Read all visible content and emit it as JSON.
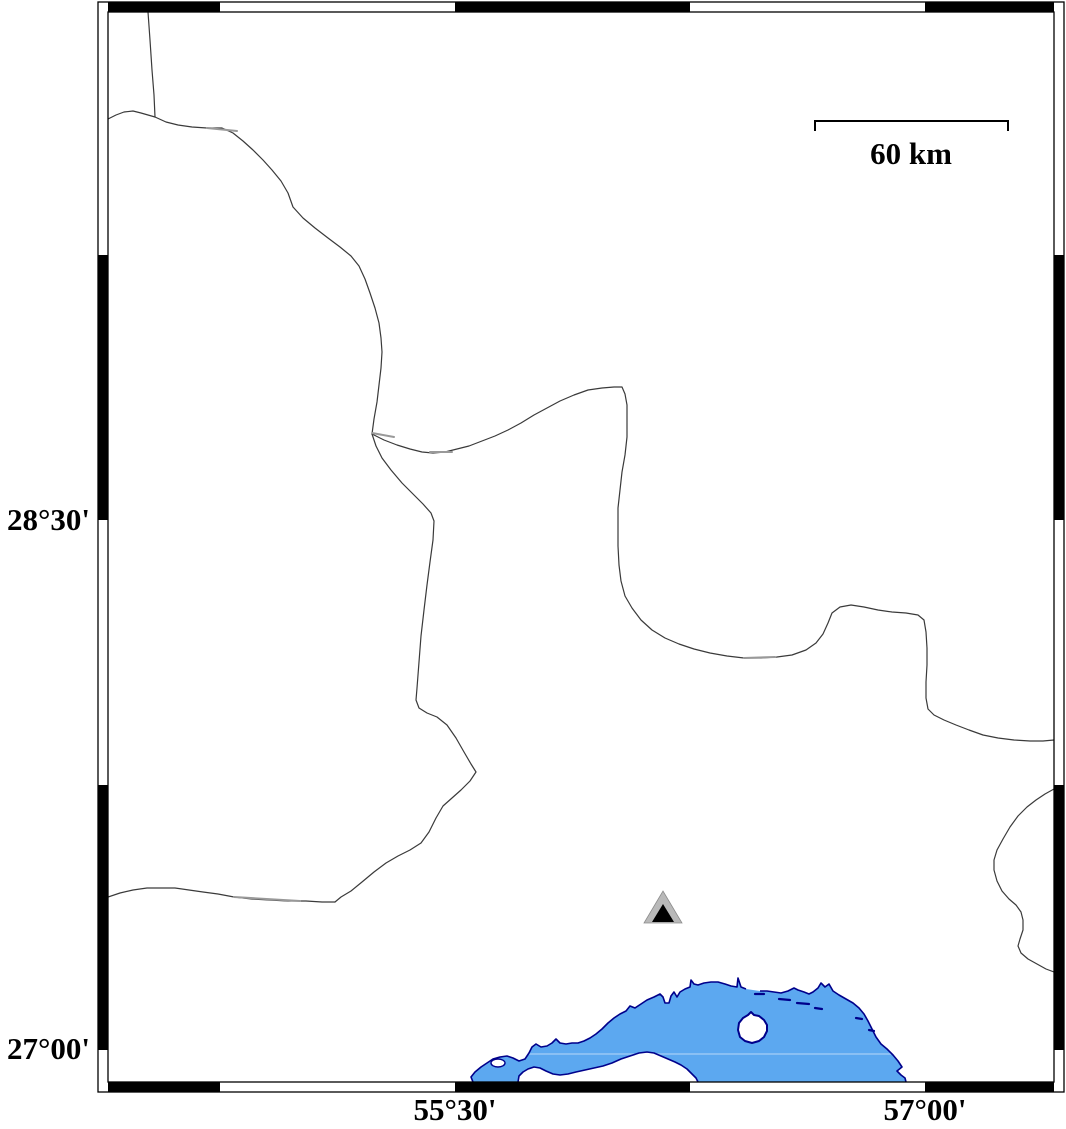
{
  "figure": {
    "width": 1066,
    "height": 1129,
    "background": "#ffffff"
  },
  "labels": {
    "lat_top": "28°30'",
    "lat_bottom": "27°00'",
    "lon_left": "55°30'",
    "lon_right": "57°00'"
  },
  "label_positions": {
    "lat_top": {
      "top": 503
    },
    "lat_bottom": {
      "top": 1032
    },
    "lon_left": {
      "left": 375,
      "top": 1093
    },
    "lon_right": {
      "left": 845,
      "top": 1093
    }
  },
  "scalebar": {
    "label": "60 km",
    "x1": 815,
    "x2": 1008,
    "y": 121,
    "cap_drop": 10,
    "label_left": 831,
    "label_top": 137
  },
  "colors": {
    "sea_fill": "#5ca8f0",
    "coast_stroke": "#00008b",
    "boundary": "#3a3a3a",
    "boundary_overlap": "#999999",
    "frame": "#000000",
    "marker_outer": "#b9b9b9",
    "marker_inner": "#000000",
    "seam": "rgba(255,255,255,0.45)"
  },
  "frame": {
    "outer": [
      98,
      2,
      1064,
      1092
    ],
    "inner": [
      108,
      12,
      1054,
      1082
    ],
    "top_black_segments": [
      [
        108,
        220
      ],
      [
        455,
        690
      ],
      [
        925,
        1054
      ]
    ],
    "bottom_black_segments": [
      [
        108,
        220
      ],
      [
        455,
        690
      ],
      [
        925,
        1054
      ]
    ],
    "left_black_segments": [
      [
        255,
        520
      ],
      [
        785,
        1050
      ]
    ],
    "right_black_segments": [
      [
        255,
        520
      ],
      [
        785,
        1050
      ]
    ]
  },
  "map_data": {
    "boundaries": [
      [
        [
          148,
          12
        ],
        [
          150,
          40
        ],
        [
          152,
          70
        ],
        [
          154,
          95
        ],
        [
          155,
          117
        ]
      ],
      [
        [
          108,
          119
        ],
        [
          116,
          115
        ],
        [
          124,
          112
        ],
        [
          133,
          111
        ],
        [
          141,
          113
        ],
        [
          148,
          115
        ],
        [
          155,
          117
        ]
      ],
      [
        [
          155,
          117
        ],
        [
          166,
          122
        ],
        [
          178,
          125
        ],
        [
          192,
          127
        ],
        [
          207,
          128
        ],
        [
          222,
          128
        ],
        [
          233,
          133
        ],
        [
          243,
          141
        ],
        [
          253,
          150
        ],
        [
          263,
          160
        ],
        [
          272,
          170
        ],
        [
          281,
          181
        ],
        [
          288,
          193
        ],
        [
          293,
          207
        ],
        [
          303,
          218
        ],
        [
          315,
          228
        ],
        [
          328,
          238
        ],
        [
          340,
          247
        ],
        [
          351,
          256
        ],
        [
          359,
          266
        ],
        [
          365,
          279
        ],
        [
          370,
          293
        ],
        [
          375,
          308
        ],
        [
          379,
          323
        ],
        [
          381,
          338
        ],
        [
          382,
          352
        ],
        [
          381,
          368
        ],
        [
          379,
          385
        ],
        [
          377,
          402
        ],
        [
          374,
          419
        ],
        [
          372,
          434
        ]
      ],
      [
        [
          372,
          434
        ],
        [
          376,
          446
        ],
        [
          382,
          458
        ],
        [
          391,
          470
        ],
        [
          402,
          483
        ],
        [
          413,
          494
        ],
        [
          423,
          504
        ],
        [
          431,
          513
        ],
        [
          434,
          521
        ],
        [
          433,
          540
        ],
        [
          430,
          562
        ],
        [
          427,
          585
        ],
        [
          424,
          610
        ],
        [
          421,
          636
        ],
        [
          419,
          662
        ],
        [
          417,
          688
        ],
        [
          416,
          700
        ],
        [
          419,
          708
        ],
        [
          427,
          713
        ],
        [
          437,
          717
        ],
        [
          447,
          725
        ],
        [
          456,
          738
        ],
        [
          464,
          752
        ],
        [
          471,
          764
        ],
        [
          476,
          772
        ],
        [
          470,
          781
        ],
        [
          461,
          790
        ],
        [
          452,
          798
        ],
        [
          443,
          806
        ],
        [
          436,
          818
        ],
        [
          429,
          832
        ],
        [
          421,
          843
        ],
        [
          410,
          850
        ],
        [
          398,
          856
        ],
        [
          386,
          863
        ],
        [
          374,
          872
        ],
        [
          362,
          882
        ],
        [
          351,
          891
        ],
        [
          341,
          897
        ],
        [
          335,
          902
        ]
      ],
      [
        [
          108,
          897
        ],
        [
          120,
          893
        ],
        [
          133,
          890
        ],
        [
          147,
          888
        ],
        [
          161,
          888
        ],
        [
          175,
          888
        ],
        [
          189,
          890
        ],
        [
          203,
          892
        ],
        [
          218,
          894
        ],
        [
          234,
          897
        ],
        [
          252,
          899
        ],
        [
          270,
          900
        ],
        [
          288,
          901
        ],
        [
          306,
          901
        ],
        [
          322,
          902
        ],
        [
          335,
          902
        ]
      ],
      [
        [
          372,
          434
        ],
        [
          384,
          440
        ],
        [
          397,
          445
        ],
        [
          410,
          449
        ],
        [
          422,
          452
        ],
        [
          433,
          453
        ],
        [
          445,
          452
        ],
        [
          457,
          449
        ],
        [
          469,
          446
        ],
        [
          482,
          441
        ],
        [
          495,
          436
        ],
        [
          508,
          430
        ],
        [
          521,
          423
        ],
        [
          534,
          415
        ],
        [
          547,
          408
        ],
        [
          560,
          401
        ],
        [
          574,
          395
        ],
        [
          588,
          390
        ],
        [
          602,
          388
        ],
        [
          614,
          387
        ],
        [
          622,
          387
        ],
        [
          625,
          394
        ],
        [
          627,
          405
        ],
        [
          627,
          420
        ],
        [
          627,
          437
        ],
        [
          625,
          455
        ],
        [
          622,
          472
        ],
        [
          620,
          490
        ],
        [
          618,
          508
        ],
        [
          618,
          527
        ],
        [
          618,
          546
        ],
        [
          619,
          565
        ],
        [
          621,
          581
        ],
        [
          625,
          596
        ],
        [
          632,
          608
        ],
        [
          641,
          620
        ],
        [
          652,
          630
        ],
        [
          665,
          638
        ],
        [
          679,
          644
        ],
        [
          694,
          649
        ],
        [
          710,
          653
        ],
        [
          727,
          656
        ],
        [
          744,
          658
        ],
        [
          761,
          658
        ],
        [
          777,
          657
        ],
        [
          792,
          655
        ],
        [
          806,
          650
        ],
        [
          816,
          643
        ],
        [
          823,
          634
        ],
        [
          828,
          623
        ],
        [
          832,
          613
        ],
        [
          840,
          607
        ],
        [
          851,
          605
        ],
        [
          864,
          607
        ],
        [
          878,
          610
        ],
        [
          892,
          612
        ],
        [
          906,
          613
        ],
        [
          918,
          615
        ],
        [
          924,
          620
        ],
        [
          926,
          632
        ],
        [
          927,
          648
        ],
        [
          927,
          665
        ],
        [
          926,
          682
        ],
        [
          926,
          698
        ],
        [
          928,
          709
        ],
        [
          934,
          715
        ],
        [
          944,
          720
        ],
        [
          956,
          725
        ],
        [
          969,
          730
        ],
        [
          983,
          735
        ],
        [
          998,
          738
        ],
        [
          1014,
          740
        ],
        [
          1030,
          741
        ],
        [
          1043,
          741
        ],
        [
          1054,
          740
        ]
      ],
      [
        [
          1054,
          789
        ],
        [
          1045,
          794
        ],
        [
          1036,
          800
        ],
        [
          1027,
          807
        ],
        [
          1018,
          816
        ],
        [
          1010,
          827
        ],
        [
          1003,
          839
        ],
        [
          997,
          850
        ],
        [
          994,
          860
        ],
        [
          994,
          870
        ],
        [
          997,
          881
        ],
        [
          1002,
          891
        ],
        [
          1009,
          899
        ],
        [
          1016,
          905
        ],
        [
          1021,
          912
        ],
        [
          1023,
          920
        ],
        [
          1023,
          930
        ],
        [
          1020,
          939
        ],
        [
          1018,
          946
        ],
        [
          1021,
          953
        ],
        [
          1028,
          959
        ],
        [
          1037,
          964
        ],
        [
          1046,
          969
        ],
        [
          1054,
          972
        ]
      ]
    ],
    "overlap_segments": [
      [
        [
          207,
          128
        ],
        [
          237,
          131
        ]
      ],
      [
        [
          372,
          433
        ],
        [
          394,
          437
        ]
      ],
      [
        [
          430,
          452
        ],
        [
          452,
          452
        ]
      ],
      [
        [
          234,
          897
        ],
        [
          300,
          901
        ]
      ],
      [
        [
          744,
          658
        ],
        [
          775,
          657
        ]
      ]
    ],
    "coast": [
      [
        473,
        1082
      ],
      [
        471,
        1077
      ],
      [
        475,
        1072
      ],
      [
        481,
        1067
      ],
      [
        487,
        1063
      ],
      [
        493,
        1059
      ],
      [
        500,
        1057
      ],
      [
        507,
        1056
      ],
      [
        513,
        1058
      ],
      [
        519,
        1061
      ],
      [
        525,
        1059
      ],
      [
        529,
        1053
      ],
      [
        532,
        1047
      ],
      [
        536,
        1044
      ],
      [
        541,
        1047
      ],
      [
        547,
        1046
      ],
      [
        552,
        1043
      ],
      [
        556,
        1039
      ],
      [
        560,
        1043
      ],
      [
        566,
        1044
      ],
      [
        572,
        1043
      ],
      [
        578,
        1043
      ],
      [
        584,
        1041
      ],
      [
        590,
        1038
      ],
      [
        596,
        1034
      ],
      [
        602,
        1029
      ],
      [
        608,
        1023
      ],
      [
        614,
        1018
      ],
      [
        620,
        1014
      ],
      [
        626,
        1011
      ],
      [
        630,
        1006
      ],
      [
        635,
        1008
      ],
      [
        641,
        1004
      ],
      [
        647,
        1000
      ],
      [
        654,
        997
      ],
      [
        660,
        994
      ],
      [
        663,
        997
      ],
      [
        665,
        1003
      ],
      [
        669,
        1003
      ],
      [
        671,
        996
      ],
      [
        674,
        992
      ],
      [
        677,
        997
      ],
      [
        680,
        992
      ],
      [
        685,
        989
      ],
      [
        690,
        987
      ],
      [
        691,
        980
      ],
      [
        694,
        984
      ],
      [
        698,
        985
      ],
      [
        704,
        983
      ],
      [
        711,
        982
      ],
      [
        718,
        982
      ],
      [
        725,
        984
      ],
      [
        731,
        986
      ],
      [
        737,
        987
      ],
      [
        738,
        978
      ],
      [
        741,
        987
      ],
      [
        746,
        989
      ],
      [
        753,
        990
      ],
      [
        760,
        991
      ],
      [
        767,
        991
      ],
      [
        774,
        992
      ],
      [
        781,
        993
      ],
      [
        788,
        991
      ],
      [
        794,
        988
      ],
      [
        798,
        990
      ],
      [
        804,
        992
      ],
      [
        809,
        994
      ],
      [
        813,
        992
      ],
      [
        818,
        988
      ],
      [
        821,
        983
      ],
      [
        825,
        987
      ],
      [
        829,
        984
      ],
      [
        833,
        991
      ],
      [
        839,
        995
      ],
      [
        846,
        999
      ],
      [
        853,
        1003
      ],
      [
        859,
        1008
      ],
      [
        864,
        1014
      ],
      [
        868,
        1021
      ],
      [
        872,
        1029
      ],
      [
        876,
        1037
      ],
      [
        881,
        1044
      ],
      [
        887,
        1049
      ],
      [
        893,
        1055
      ],
      [
        898,
        1061
      ],
      [
        902,
        1067
      ],
      [
        897,
        1071
      ],
      [
        901,
        1075
      ],
      [
        905,
        1078
      ],
      [
        906,
        1082
      ]
    ],
    "coast_stroke_gap": [
      56,
      58
    ],
    "sea_bottom_y": 1082,
    "seam_y": 1054,
    "seam_x": [
      473,
      906
    ],
    "coast_dashes": [
      [
        [
          755,
          994
        ],
        [
          764,
          994
        ]
      ],
      [
        [
          779,
          999
        ],
        [
          790,
          1000
        ]
      ],
      [
        [
          797,
          1003
        ],
        [
          809,
          1004
        ]
      ],
      [
        [
          815,
          1008
        ],
        [
          822,
          1009
        ]
      ],
      [
        [
          856,
          1018
        ],
        [
          862,
          1019
        ]
      ],
      [
        [
          869,
          1030
        ],
        [
          874,
          1031
        ]
      ]
    ],
    "islands": {
      "lagoon_islet": {
        "cx": 498,
        "cy": 1063,
        "rx": 7,
        "ry": 4
      },
      "qeshm": [
        [
          518,
          1082
        ],
        [
          519,
          1076
        ],
        [
          523,
          1072
        ],
        [
          528,
          1069
        ],
        [
          534,
          1067
        ],
        [
          540,
          1068
        ],
        [
          546,
          1071
        ],
        [
          553,
          1074
        ],
        [
          560,
          1075
        ],
        [
          568,
          1074
        ],
        [
          576,
          1072
        ],
        [
          585,
          1070
        ],
        [
          594,
          1068
        ],
        [
          603,
          1066
        ],
        [
          612,
          1063
        ],
        [
          621,
          1059
        ],
        [
          630,
          1056
        ],
        [
          639,
          1053
        ],
        [
          647,
          1052
        ],
        [
          654,
          1053
        ],
        [
          661,
          1056
        ],
        [
          668,
          1059
        ],
        [
          675,
          1062
        ],
        [
          681,
          1065
        ],
        [
          687,
          1069
        ],
        [
          692,
          1074
        ],
        [
          696,
          1078
        ],
        [
          698,
          1082
        ]
      ],
      "hormuz": [
        [
          738,
          1030
        ],
        [
          739,
          1023
        ],
        [
          743,
          1018
        ],
        [
          748,
          1015
        ],
        [
          751,
          1012
        ],
        [
          754,
          1015
        ],
        [
          759,
          1016
        ],
        [
          764,
          1020
        ],
        [
          767,
          1025
        ],
        [
          767,
          1031
        ],
        [
          764,
          1037
        ],
        [
          759,
          1041
        ],
        [
          752,
          1043
        ],
        [
          745,
          1041
        ],
        [
          740,
          1037
        ],
        [
          738,
          1030
        ]
      ]
    },
    "station_marker": {
      "outer_triangle": [
        [
          644,
          923
        ],
        [
          682,
          923
        ],
        [
          663,
          891
        ]
      ],
      "inner_triangle": [
        [
          652,
          922
        ],
        [
          674,
          922
        ],
        [
          663,
          904
        ]
      ]
    }
  }
}
